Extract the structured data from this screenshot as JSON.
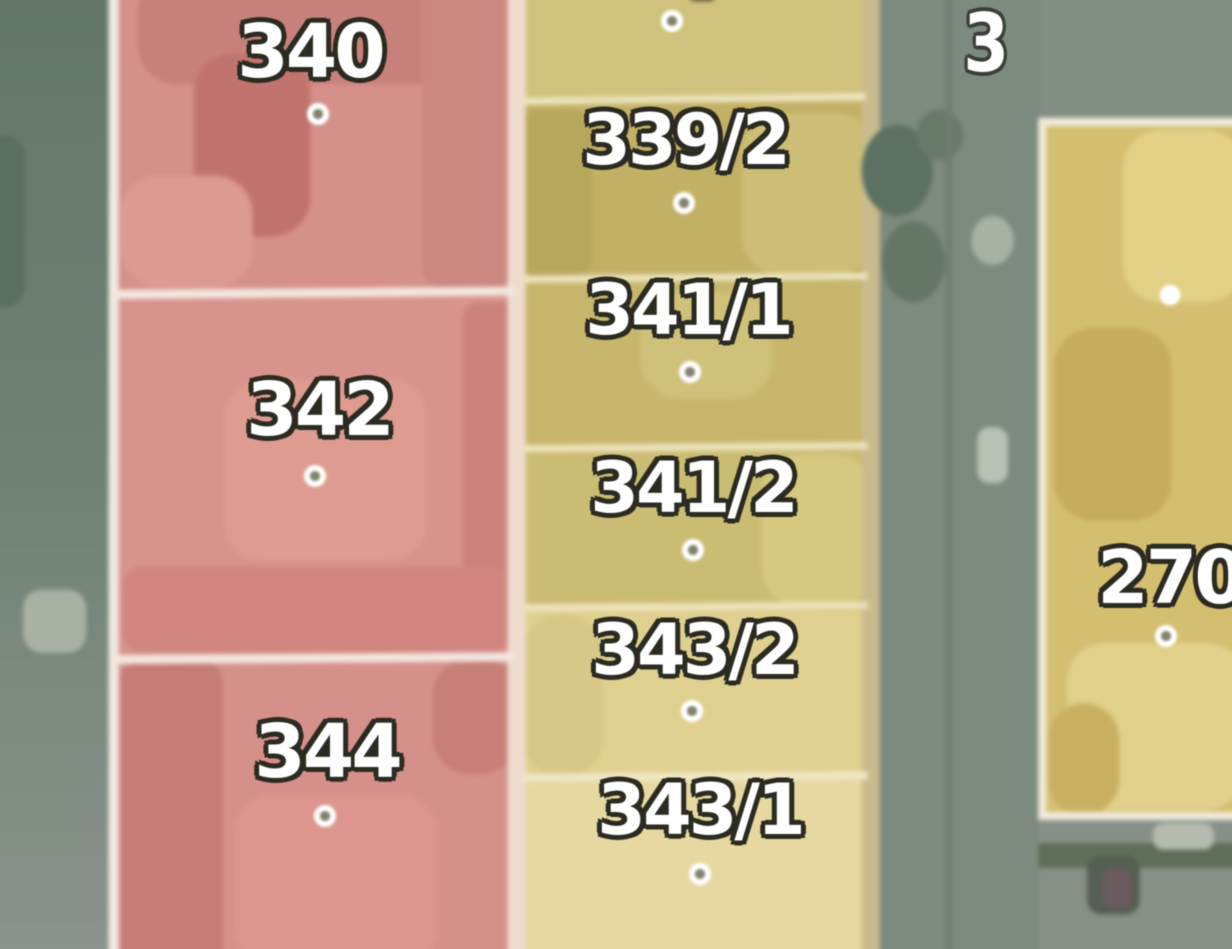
{
  "map": {
    "description": "Aerial cadastral map with colored parcel overlays, white boundary lines and parcel number labels with centroid dots",
    "corner_label": "3",
    "parcels": [
      {
        "label": "340",
        "color_group": "red"
      },
      {
        "label": "342",
        "color_group": "red"
      },
      {
        "label": "344",
        "color_group": "red"
      },
      {
        "label": "339/2",
        "color_group": "yellow"
      },
      {
        "label": "341/1",
        "color_group": "yellow"
      },
      {
        "label": "341/2",
        "color_group": "yellow"
      },
      {
        "label": "343/2",
        "color_group": "yellow"
      },
      {
        "label": "343/1",
        "color_group": "yellow"
      },
      {
        "label": "270",
        "color_group": "yellow"
      }
    ],
    "colors": {
      "parcel_red": "#d6908a",
      "parcel_red_dark": "#c47c75",
      "parcel_yellow_olive": "#c2b065",
      "parcel_yellow_light": "#e6d8a0",
      "parcel_tan": "#d4be70",
      "road_gray": "#7e8b80",
      "road_gray_light": "#8a938c",
      "boundary_white": "#f0ebe2",
      "label_fill": "#ffffff",
      "label_outline": "#2b2b22"
    }
  }
}
